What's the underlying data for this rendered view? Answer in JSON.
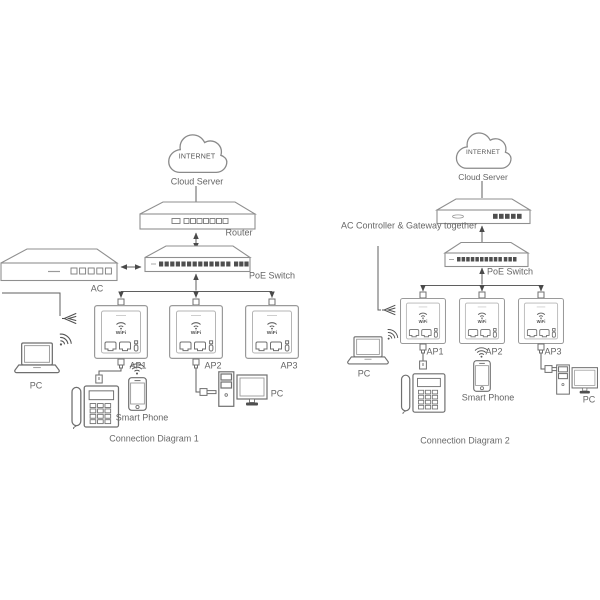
{
  "diagram1": {
    "title": "Connection Diagram 1",
    "internet": "INTERNET",
    "cloud_server": "Cloud Server",
    "router": "Router",
    "poe_switch": "PoE Switch",
    "ac": "AC",
    "ap_wifi": "WiFi",
    "aps": [
      "AP1",
      "AP2",
      "AP3"
    ],
    "laptop_pc": "PC",
    "smart_phone": "Smart Phone",
    "desktop_pc": "PC"
  },
  "diagram2": {
    "title": "Connection Diagram 2",
    "internet": "INTERNET",
    "cloud_server": "Cloud Server",
    "ac_gateway": "AC Controller & Gateway together",
    "poe_switch": "PoE Switch",
    "ap_wifi": "WiFi",
    "aps": [
      "AP1",
      "AP2",
      "AP3"
    ],
    "laptop_pc": "PC",
    "smart_phone": "Smart Phone",
    "desktop_pc": "PC"
  },
  "colors": {
    "line": "#5f5f5f",
    "device_stroke": "#8f8f8f",
    "text": "#666666",
    "port_fill": "#4f4f4f"
  }
}
